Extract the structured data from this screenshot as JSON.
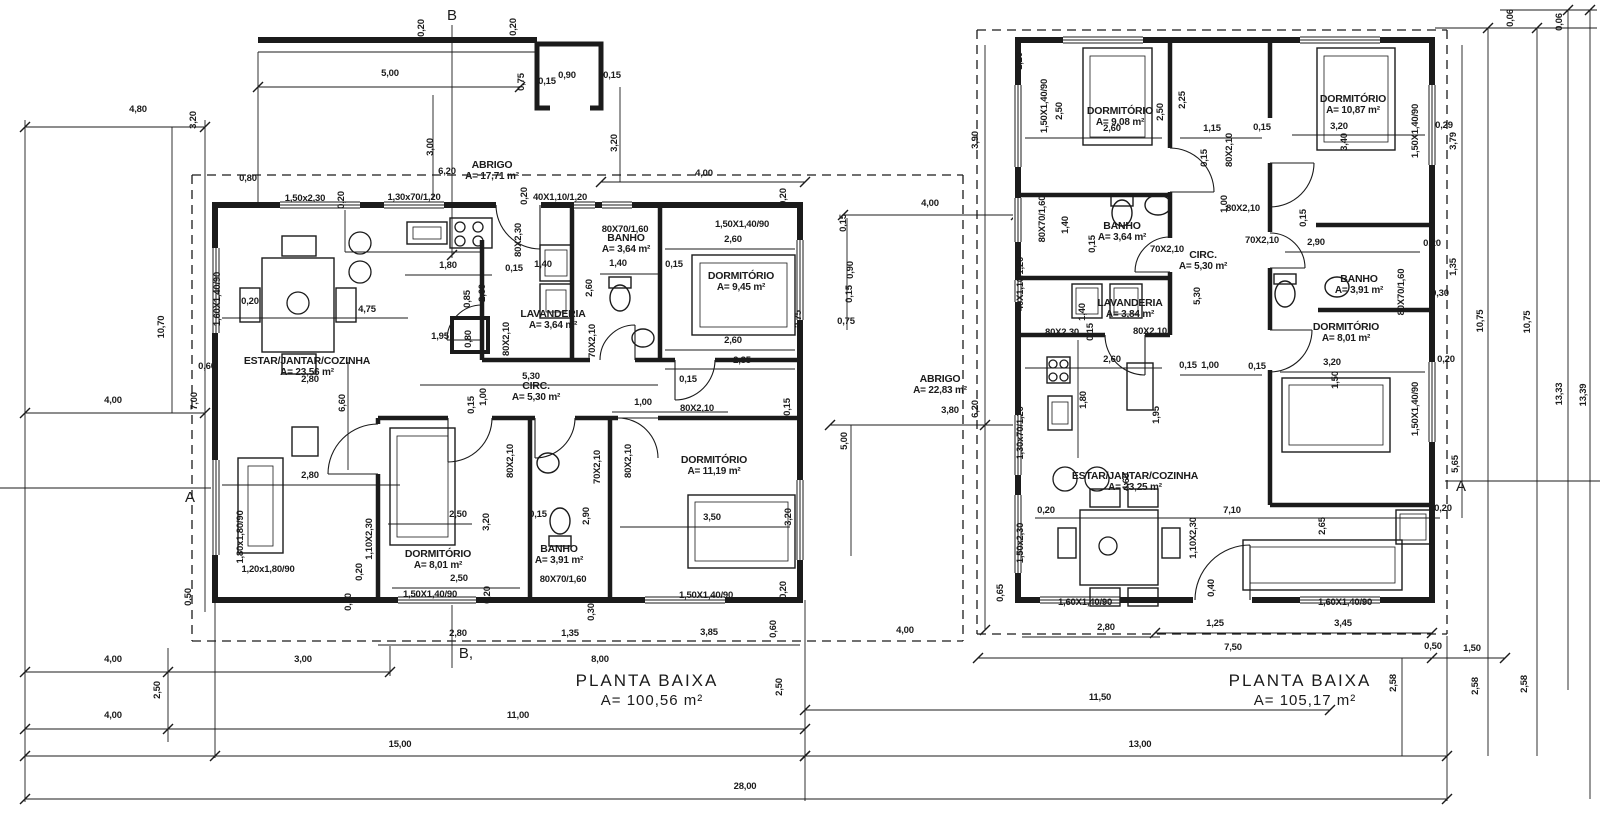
{
  "drawing": {
    "background": "#ffffff",
    "line_color": "#1b1b1b",
    "plans": [
      {
        "id": "left",
        "title": "PLANTA BAIXA",
        "area_label": "A= 100,56 m²",
        "title_x": 647,
        "title_y": 686,
        "rooms": [
          {
            "name": "ESTAR/JANTAR/COZINHA",
            "area": "A= 23,56 m²",
            "x": 307,
            "y": 364
          },
          {
            "name": "LAVANDERIA",
            "area": "A= 3,64 m²",
            "x": 553,
            "y": 317
          },
          {
            "name": "BANHO",
            "area": "A= 3,64 m²",
            "x": 626,
            "y": 241
          },
          {
            "name": "DORMITÓRIO",
            "area": "A= 9,45 m²",
            "x": 741,
            "y": 279
          },
          {
            "name": "CIRC.",
            "area": "A= 5,30 m²",
            "x": 536,
            "y": 389
          },
          {
            "name": "DORMITÓRIO",
            "area": "A= 8,01 m²",
            "x": 438,
            "y": 557
          },
          {
            "name": "BANHO",
            "area": "A= 3,91 m²",
            "x": 559,
            "y": 552
          },
          {
            "name": "DORMITÓRIO",
            "area": "A= 11,19 m²",
            "x": 714,
            "y": 463
          },
          {
            "name": "ABRIGO",
            "area": "A= 17,71 m²",
            "x": 492,
            "y": 168
          }
        ]
      },
      {
        "id": "right",
        "title": "PLANTA BAIXA",
        "area_label": "A= 105,17 m²",
        "title_x": 1300,
        "title_y": 686,
        "rooms": [
          {
            "name": "DORMITÓRIO",
            "area": "A= 9,08 m²",
            "x": 1120,
            "y": 114
          },
          {
            "name": "DORMITÓRIO",
            "area": "A= 10,87 m²",
            "x": 1353,
            "y": 102
          },
          {
            "name": "BANHO",
            "area": "A= 3,64 m²",
            "x": 1122,
            "y": 229
          },
          {
            "name": "CIRC.",
            "area": "A= 5,30 m²",
            "x": 1203,
            "y": 258
          },
          {
            "name": "BANHO",
            "area": "A= 3,91 m²",
            "x": 1359,
            "y": 282
          },
          {
            "name": "DORMITÓRIO",
            "area": "A= 8,01 m²",
            "x": 1346,
            "y": 330
          },
          {
            "name": "LAVANDERIA",
            "area": "A= 3,84 m²",
            "x": 1130,
            "y": 306
          },
          {
            "name": "ABRIGO",
            "area": "A= 22,83 m²",
            "x": 940,
            "y": 382
          },
          {
            "name": "ESTAR/JANTAR/COZINHA",
            "area": "A= 23,25 m²",
            "x": 1135,
            "y": 479
          }
        ]
      }
    ],
    "section_markers": [
      {
        "t": "B",
        "x": 452,
        "y": 20
      },
      {
        "t": "B,",
        "x": 466,
        "y": 658
      },
      {
        "t": "A",
        "x": 190,
        "y": 502
      },
      {
        "t": "A",
        "x": 1461,
        "y": 491
      }
    ],
    "dim_labels": [
      {
        "t": "4,80",
        "x": 138,
        "y": 112
      },
      {
        "t": "3,20",
        "x": 196,
        "y": 120,
        "r": 1
      },
      {
        "t": "10,70",
        "x": 164,
        "y": 327,
        "r": 1
      },
      {
        "t": "4,00",
        "x": 113,
        "y": 403
      },
      {
        "t": "7,00",
        "x": 197,
        "y": 401,
        "r": 1
      },
      {
        "t": "0,60",
        "x": 207,
        "y": 369
      },
      {
        "t": "4,00",
        "x": 113,
        "y": 662
      },
      {
        "t": "3,00",
        "x": 303,
        "y": 662
      },
      {
        "t": "2,50",
        "x": 160,
        "y": 690,
        "r": 1
      },
      {
        "t": "4,00",
        "x": 113,
        "y": 718
      },
      {
        "t": "11,00",
        "x": 518,
        "y": 718
      },
      {
        "t": "8,00",
        "x": 600,
        "y": 662
      },
      {
        "t": "15,00",
        "x": 400,
        "y": 747
      },
      {
        "t": "13,00",
        "x": 1140,
        "y": 747
      },
      {
        "t": "28,00",
        "x": 745,
        "y": 789
      },
      {
        "t": "11,50",
        "x": 1100,
        "y": 700
      },
      {
        "t": "2,50",
        "x": 782,
        "y": 687,
        "r": 1
      },
      {
        "t": "2,58",
        "x": 1396,
        "y": 683,
        "r": 1
      },
      {
        "t": "2,58",
        "x": 1478,
        "y": 686,
        "r": 1
      },
      {
        "t": "2,58",
        "x": 1527,
        "y": 684,
        "r": 1
      },
      {
        "t": "0,20",
        "x": 424,
        "y": 28,
        "r": 1
      },
      {
        "t": "0,20",
        "x": 516,
        "y": 27,
        "r": 1
      },
      {
        "t": "5,00",
        "x": 390,
        "y": 76
      },
      {
        "t": "0,75",
        "x": 524,
        "y": 82,
        "r": 1
      },
      {
        "t": "0,15",
        "x": 547,
        "y": 84
      },
      {
        "t": "0,90",
        "x": 567,
        "y": 78
      },
      {
        "t": "0,15",
        "x": 612,
        "y": 78
      },
      {
        "t": "3,00",
        "x": 433,
        "y": 147,
        "r": 1
      },
      {
        "t": "3,20",
        "x": 617,
        "y": 143,
        "r": 1
      },
      {
        "t": "6,20",
        "x": 447,
        "y": 174
      },
      {
        "t": "4,00",
        "x": 704,
        "y": 176
      },
      {
        "t": "0,80",
        "x": 248,
        "y": 181
      },
      {
        "t": "1,50x2,30",
        "x": 305,
        "y": 201
      },
      {
        "t": "0,20",
        "x": 344,
        "y": 200,
        "r": 1
      },
      {
        "t": "1,30x70/1,20",
        "x": 414,
        "y": 200
      },
      {
        "t": "40X1,10/1,20",
        "x": 560,
        "y": 200
      },
      {
        "t": "0,20",
        "x": 527,
        "y": 196,
        "r": 1
      },
      {
        "t": "0,20",
        "x": 786,
        "y": 197,
        "r": 1
      },
      {
        "t": "1,60X1,40/90",
        "x": 220,
        "y": 299,
        "r": 1
      },
      {
        "t": "0,20",
        "x": 250,
        "y": 304
      },
      {
        "t": "4,75",
        "x": 367,
        "y": 312
      },
      {
        "t": "1,80",
        "x": 448,
        "y": 268
      },
      {
        "t": "0,15",
        "x": 514,
        "y": 271
      },
      {
        "t": "1,40",
        "x": 543,
        "y": 267
      },
      {
        "t": "80X2,30",
        "x": 521,
        "y": 240,
        "r": 1
      },
      {
        "t": "2,60",
        "x": 485,
        "y": 293,
        "r": 1
      },
      {
        "t": "0,85",
        "x": 470,
        "y": 299,
        "r": 1
      },
      {
        "t": "1,95",
        "x": 440,
        "y": 339
      },
      {
        "t": "0,80",
        "x": 471,
        "y": 339,
        "r": 1
      },
      {
        "t": "80X2,10",
        "x": 509,
        "y": 339,
        "r": 1
      },
      {
        "t": "70X2,10",
        "x": 595,
        "y": 341,
        "r": 1
      },
      {
        "t": "2,60",
        "x": 592,
        "y": 288,
        "r": 1
      },
      {
        "t": "80X70/1,60",
        "x": 625,
        "y": 232
      },
      {
        "t": "1,40",
        "x": 618,
        "y": 266
      },
      {
        "t": "0,15",
        "x": 674,
        "y": 267
      },
      {
        "t": "1,50X1,40/90",
        "x": 742,
        "y": 227
      },
      {
        "t": "2,60",
        "x": 733,
        "y": 242
      },
      {
        "t": "2,60",
        "x": 733,
        "y": 343
      },
      {
        "t": "2,35",
        "x": 742,
        "y": 363
      },
      {
        "t": "0,15",
        "x": 688,
        "y": 382
      },
      {
        "t": "2,75",
        "x": 801,
        "y": 319,
        "r": 1
      },
      {
        "t": "2,80",
        "x": 310,
        "y": 382
      },
      {
        "t": "6,60",
        "x": 345,
        "y": 403,
        "r": 1
      },
      {
        "t": "5,30",
        "x": 531,
        "y": 379
      },
      {
        "t": "1,00",
        "x": 486,
        "y": 397,
        "r": 1
      },
      {
        "t": "0,15",
        "x": 474,
        "y": 405,
        "r": 1
      },
      {
        "t": "1,00",
        "x": 643,
        "y": 405
      },
      {
        "t": "80X2,10",
        "x": 697,
        "y": 411
      },
      {
        "t": "0,15",
        "x": 790,
        "y": 407,
        "r": 1
      },
      {
        "t": "80X2,10",
        "x": 513,
        "y": 461,
        "r": 1
      },
      {
        "t": "70X2,10",
        "x": 600,
        "y": 467,
        "r": 1
      },
      {
        "t": "80X2,10",
        "x": 631,
        "y": 461,
        "r": 1
      },
      {
        "t": "2,90",
        "x": 589,
        "y": 516,
        "r": 1
      },
      {
        "t": "0,15",
        "x": 538,
        "y": 517
      },
      {
        "t": "80X70/1,60",
        "x": 563,
        "y": 582
      },
      {
        "t": "2,50",
        "x": 458,
        "y": 517
      },
      {
        "t": "3,20",
        "x": 489,
        "y": 522,
        "r": 1
      },
      {
        "t": "2,50",
        "x": 459,
        "y": 581
      },
      {
        "t": "1,50X1,40/90",
        "x": 430,
        "y": 597
      },
      {
        "t": "0,20",
        "x": 490,
        "y": 595,
        "r": 1
      },
      {
        "t": "1,10X2,30",
        "x": 372,
        "y": 539,
        "r": 1
      },
      {
        "t": "0,20",
        "x": 362,
        "y": 572,
        "r": 1
      },
      {
        "t": "0,50",
        "x": 351,
        "y": 602,
        "r": 1
      },
      {
        "t": "0,50",
        "x": 191,
        "y": 597,
        "r": 1
      },
      {
        "t": "1,80x1,80/90",
        "x": 243,
        "y": 537,
        "r": 1
      },
      {
        "t": "1,20x1,80/90",
        "x": 268,
        "y": 572
      },
      {
        "t": "2,80",
        "x": 310,
        "y": 478
      },
      {
        "t": "3,50",
        "x": 712,
        "y": 520
      },
      {
        "t": "3,20",
        "x": 791,
        "y": 517,
        "r": 1
      },
      {
        "t": "1,50X1,40/90",
        "x": 706,
        "y": 598
      },
      {
        "t": "0,20",
        "x": 786,
        "y": 590,
        "r": 1
      },
      {
        "t": "0,60",
        "x": 776,
        "y": 629,
        "r": 1
      },
      {
        "t": "0,30",
        "x": 594,
        "y": 612,
        "r": 1
      },
      {
        "t": "2,80",
        "x": 458,
        "y": 636
      },
      {
        "t": "1,35",
        "x": 570,
        "y": 636
      },
      {
        "t": "3,85",
        "x": 709,
        "y": 635
      },
      {
        "t": "4,00",
        "x": 930,
        "y": 206
      },
      {
        "t": "0,15",
        "x": 846,
        "y": 223,
        "r": 1
      },
      {
        "t": "0,90",
        "x": 853,
        "y": 270,
        "r": 1
      },
      {
        "t": "0,15",
        "x": 852,
        "y": 294,
        "r": 1
      },
      {
        "t": "0,75",
        "x": 846,
        "y": 324
      },
      {
        "t": "3,80",
        "x": 950,
        "y": 413
      },
      {
        "t": "6,20",
        "x": 978,
        "y": 409,
        "r": 1
      },
      {
        "t": "5,00",
        "x": 847,
        "y": 441,
        "r": 1
      },
      {
        "t": "3,90",
        "x": 978,
        "y": 140,
        "r": 1
      },
      {
        "t": "4,00",
        "x": 905,
        "y": 633
      },
      {
        "t": "1,20",
        "x": 1022,
        "y": 61,
        "r": 1
      },
      {
        "t": "1,50X1,40/90",
        "x": 1047,
        "y": 106,
        "r": 1
      },
      {
        "t": "2,50",
        "x": 1062,
        "y": 111,
        "r": 1
      },
      {
        "t": "2,60",
        "x": 1112,
        "y": 131
      },
      {
        "t": "2,50",
        "x": 1163,
        "y": 112,
        "r": 1
      },
      {
        "t": "2,25",
        "x": 1185,
        "y": 100,
        "r": 1
      },
      {
        "t": "1,15",
        "x": 1212,
        "y": 131
      },
      {
        "t": "0,15",
        "x": 1207,
        "y": 158,
        "r": 1
      },
      {
        "t": "80X2,10",
        "x": 1232,
        "y": 150,
        "r": 1
      },
      {
        "t": "0,15",
        "x": 1262,
        "y": 130
      },
      {
        "t": "1,00",
        "x": 1227,
        "y": 204,
        "r": 1
      },
      {
        "t": "3,20",
        "x": 1339,
        "y": 129
      },
      {
        "t": "3,40",
        "x": 1347,
        "y": 142,
        "r": 1
      },
      {
        "t": "1,50X1,40/90",
        "x": 1418,
        "y": 131,
        "r": 1
      },
      {
        "t": "0,29",
        "x": 1444,
        "y": 128
      },
      {
        "t": "3,79",
        "x": 1456,
        "y": 141,
        "r": 1
      },
      {
        "t": "0,06",
        "x": 1513,
        "y": 18,
        "r": 1
      },
      {
        "t": "0,06",
        "x": 1562,
        "y": 22,
        "r": 1
      },
      {
        "t": "10,75",
        "x": 1483,
        "y": 321,
        "r": 1
      },
      {
        "t": "10,75",
        "x": 1530,
        "y": 322,
        "r": 1
      },
      {
        "t": "13,33",
        "x": 1562,
        "y": 394,
        "r": 1
      },
      {
        "t": "13,39",
        "x": 1586,
        "y": 395,
        "r": 1
      },
      {
        "t": "80X70/1,60",
        "x": 1045,
        "y": 219,
        "r": 1
      },
      {
        "t": "1,40",
        "x": 1068,
        "y": 225,
        "r": 1
      },
      {
        "t": "0,15",
        "x": 1095,
        "y": 244,
        "r": 1
      },
      {
        "t": "70X2,10",
        "x": 1167,
        "y": 252
      },
      {
        "t": "5,30",
        "x": 1200,
        "y": 296,
        "r": 1
      },
      {
        "t": "80X2,10",
        "x": 1243,
        "y": 211
      },
      {
        "t": "70X2,10",
        "x": 1262,
        "y": 243
      },
      {
        "t": "2,90",
        "x": 1316,
        "y": 245
      },
      {
        "t": "0,15",
        "x": 1306,
        "y": 218,
        "r": 1
      },
      {
        "t": "0,30",
        "x": 1440,
        "y": 296
      },
      {
        "t": "0,20",
        "x": 1432,
        "y": 246
      },
      {
        "t": "1,35",
        "x": 1456,
        "y": 267,
        "r": 1
      },
      {
        "t": "80X70/1,60",
        "x": 1404,
        "y": 292,
        "r": 1
      },
      {
        "t": "80X2,10",
        "x": 1150,
        "y": 334
      },
      {
        "t": "80X2,30",
        "x": 1062,
        "y": 335
      },
      {
        "t": "0,15",
        "x": 1093,
        "y": 332,
        "r": 1
      },
      {
        "t": "1,40",
        "x": 1085,
        "y": 312,
        "r": 1
      },
      {
        "t": "40X1,10/1,20",
        "x": 1023,
        "y": 284,
        "r": 1
      },
      {
        "t": "1,30x70/1,20",
        "x": 1023,
        "y": 433,
        "r": 1
      },
      {
        "t": "2,60",
        "x": 1112,
        "y": 362
      },
      {
        "t": "1,80",
        "x": 1086,
        "y": 400,
        "r": 1
      },
      {
        "t": "1,95",
        "x": 1159,
        "y": 415,
        "r": 1
      },
      {
        "t": "0,15",
        "x": 1188,
        "y": 368
      },
      {
        "t": "1,00",
        "x": 1210,
        "y": 368
      },
      {
        "t": "0,15",
        "x": 1257,
        "y": 369
      },
      {
        "t": "3,20",
        "x": 1332,
        "y": 365
      },
      {
        "t": "1,50",
        "x": 1338,
        "y": 380,
        "r": 1
      },
      {
        "t": "0,20",
        "x": 1446,
        "y": 362
      },
      {
        "t": "1,50X1,40/90",
        "x": 1418,
        "y": 409,
        "r": 1
      },
      {
        "t": "4,60",
        "x": 1129,
        "y": 482,
        "r": 1
      },
      {
        "t": "7,10",
        "x": 1232,
        "y": 513
      },
      {
        "t": "2,65",
        "x": 1325,
        "y": 526,
        "r": 1
      },
      {
        "t": "0,20",
        "x": 1046,
        "y": 513
      },
      {
        "t": "0,20",
        "x": 1443,
        "y": 511
      },
      {
        "t": "1,50x2,30",
        "x": 1023,
        "y": 543,
        "r": 1
      },
      {
        "t": "1,10X2,30",
        "x": 1196,
        "y": 538,
        "r": 1
      },
      {
        "t": "0,40",
        "x": 1214,
        "y": 588,
        "r": 1
      },
      {
        "t": "0,65",
        "x": 1003,
        "y": 593,
        "r": 1
      },
      {
        "t": "1,60X1,40/90",
        "x": 1085,
        "y": 605
      },
      {
        "t": "1,60X1,40/90",
        "x": 1345,
        "y": 605
      },
      {
        "t": "2,80",
        "x": 1106,
        "y": 630
      },
      {
        "t": "1,25",
        "x": 1215,
        "y": 626
      },
      {
        "t": "3,45",
        "x": 1343,
        "y": 626
      },
      {
        "t": "7,50",
        "x": 1233,
        "y": 650
      },
      {
        "t": "0,50",
        "x": 1433,
        "y": 649
      },
      {
        "t": "1,50",
        "x": 1472,
        "y": 651
      },
      {
        "t": "5,65",
        "x": 1458,
        "y": 464,
        "r": 1
      }
    ]
  }
}
